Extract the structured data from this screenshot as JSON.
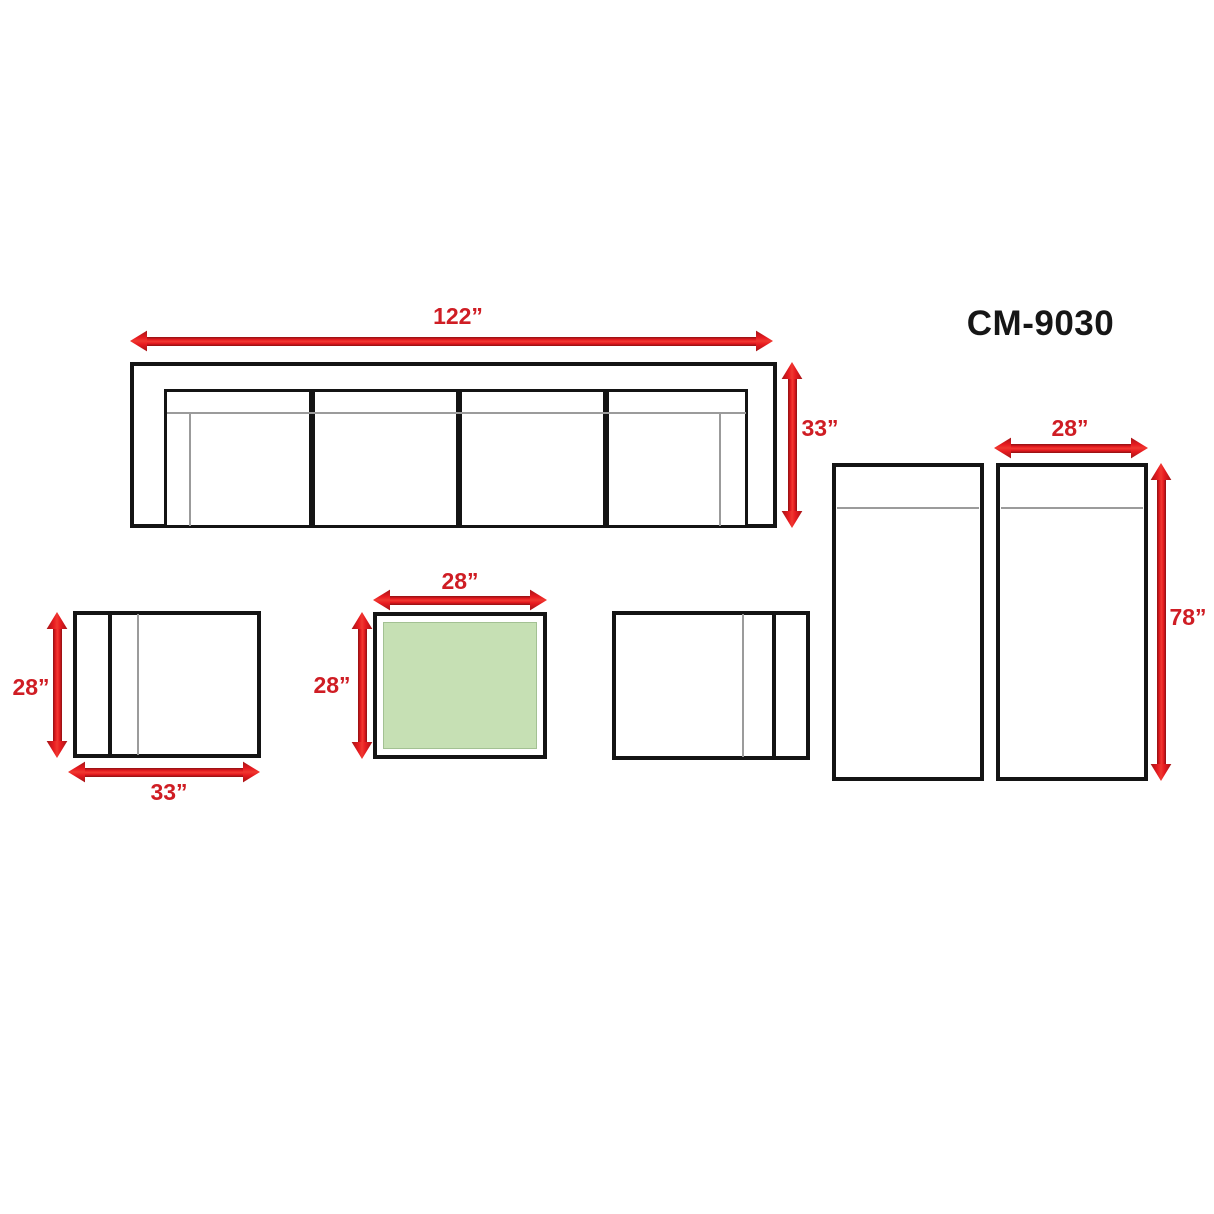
{
  "title": "CM-9030",
  "colors": {
    "dimension_red": "#cf1d24",
    "outline_black": "#141414",
    "detail_gray": "#9b9b9b",
    "table_top_green": "#c6e0b4",
    "background": "#ffffff"
  },
  "pieces": {
    "sofa": {
      "width_label": "122”",
      "depth_label": "33”"
    },
    "chaise": {
      "width_label": "28”",
      "length_label": "78”"
    },
    "corner_table_left": {
      "width_label": "33”",
      "depth_label": "28”"
    },
    "coffee_table": {
      "width_label": "28”",
      "depth_label": "28”"
    }
  }
}
